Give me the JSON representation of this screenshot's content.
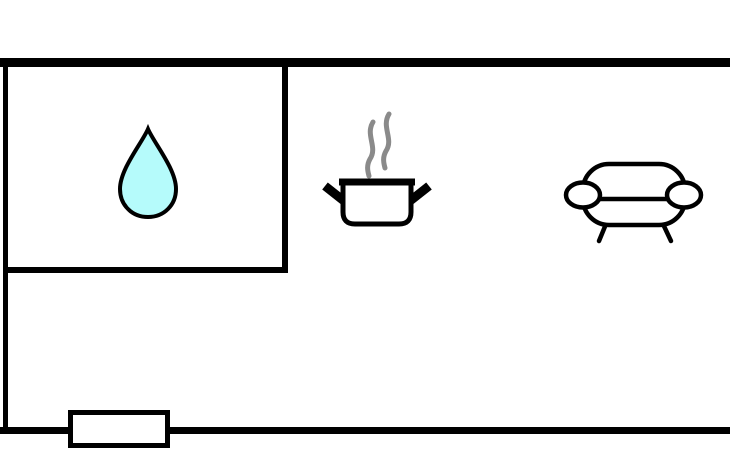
{
  "canvas": {
    "width": 730,
    "height": 450,
    "background": "#ffffff"
  },
  "colors": {
    "wall": "#000000",
    "outline": "#000000",
    "interior": "#ffffff",
    "water": "#b5fbfb",
    "steam": "#8a8a8a"
  },
  "icons": [
    {
      "name": "water-drop-icon"
    },
    {
      "name": "cooking-pot-icon"
    },
    {
      "name": "steam-icon"
    },
    {
      "name": "sofa-icon"
    },
    {
      "name": "door-opening"
    }
  ]
}
